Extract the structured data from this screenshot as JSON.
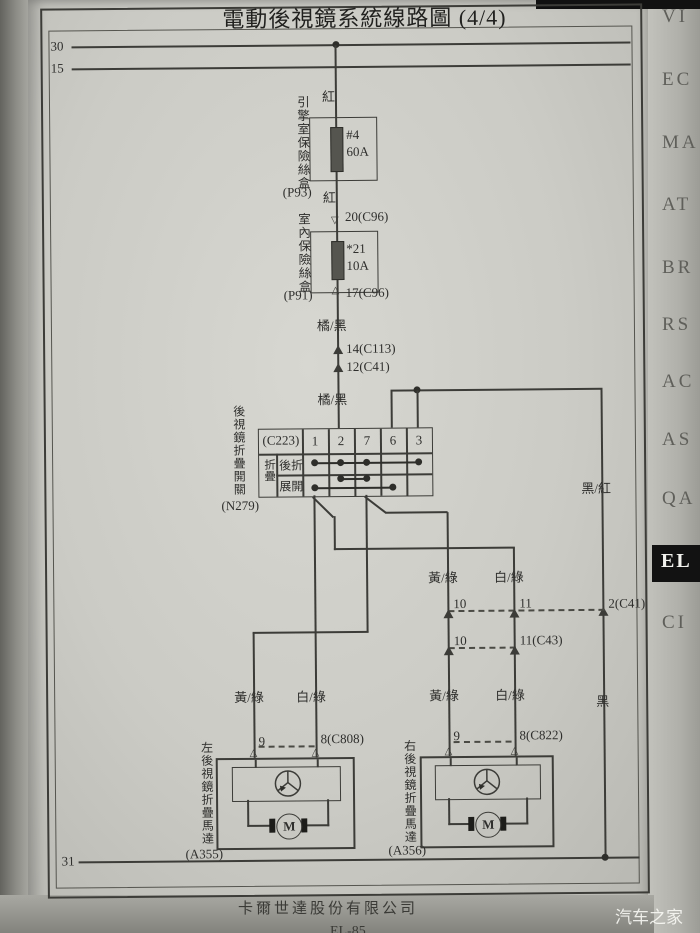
{
  "page": {
    "title": "電動後視鏡系統線路圖 (4/4)",
    "company": "卡爾世達股份有限公司",
    "page_code": "EL-85",
    "watermark": "汽车之家"
  },
  "tabs": {
    "items": [
      {
        "label": "VI"
      },
      {
        "label": "EC"
      },
      {
        "label": "MA"
      },
      {
        "label": "AT"
      },
      {
        "label": "BR"
      },
      {
        "label": "RS"
      },
      {
        "label": "AC"
      },
      {
        "label": "AS"
      },
      {
        "label": "QA"
      },
      {
        "label": "EL"
      },
      {
        "label": "CI"
      }
    ],
    "active": "EL"
  },
  "buses": {
    "b30": "30",
    "b15": "15",
    "b31": "31"
  },
  "supply": {
    "red1": "紅",
    "engine_fusebox": {
      "label": "引擎室保險絲盒",
      "code": "(P93)",
      "fuse_no": "#4",
      "rating": "60A"
    },
    "red2": "紅",
    "conn20": "20(C96)",
    "cabin_fusebox": {
      "label": "室內保險絲盒",
      "code": "(P91)",
      "fuse_no": "*21",
      "rating": "10A"
    },
    "conn17": "17(C96)",
    "ob1": "橘/黑",
    "conn14": "14(C113)",
    "conn12": "12(C41)",
    "ob2": "橘/黑"
  },
  "switch_block": {
    "label": "後視鏡折疊開關",
    "code": "(N279)",
    "connector": "(C223)",
    "pins": [
      "1",
      "2",
      "7",
      "6",
      "3"
    ],
    "mode_group": "折疊",
    "row_fold": "後折",
    "row_extend": "展開"
  },
  "ground_branch": {
    "black_red": "黑/紅",
    "conn2": "2(C41)",
    "black": "黑"
  },
  "inline_conn": {
    "c41_10": "10",
    "c41_11": "11",
    "c43_10": "10",
    "c43_11": "11(C43)"
  },
  "wire_labels": {
    "yg_upper": "黃/綠",
    "wg_upper": "白/綠",
    "lm_yg": "黃/綠",
    "lm_wg": "白/綠",
    "rm_yg": "黃/綠",
    "rm_wg": "白/綠"
  },
  "left_motor": {
    "label": "左後視鏡折疊馬達",
    "code": "(A355)",
    "pin9": "9",
    "pin8": "8(C808)",
    "motor_letter": "M"
  },
  "right_motor": {
    "label": "右後視鏡折疊馬達",
    "code": "(A356)",
    "pin9": "9",
    "pin8": "8(C822)",
    "motor_letter": "M"
  }
}
